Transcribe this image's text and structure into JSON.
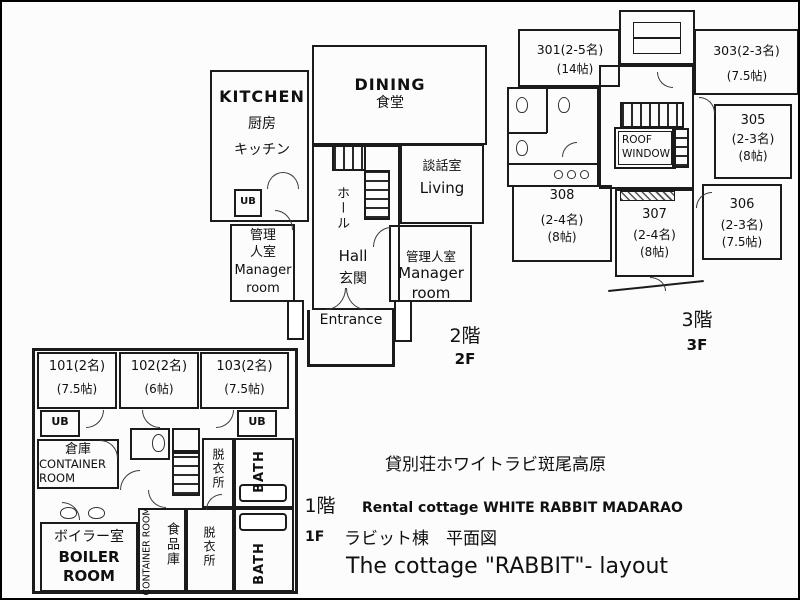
{
  "floor2": {
    "kitchen_en": "KITCHEN",
    "kitchen_jp1": "厨房",
    "kitchen_jp2": "キッチン",
    "dining_en": "DINING",
    "dining_jp": "食堂",
    "living_jp": "談話室",
    "living_en": "Living",
    "hall_jp": "ホール",
    "hall_en": "Hall",
    "genkan_jp": "玄関",
    "entrance_en": "Entrance",
    "ub": "UB",
    "mgr_left_jp1": "管理",
    "mgr_left_jp2": "人室",
    "mgr_left_en1": "Manager",
    "mgr_left_en2": "room",
    "mgr_right_jp": "管理人室",
    "mgr_right_en1": "Manager",
    "mgr_right_en2": "room",
    "floor_jp": "2階",
    "floor_en": "2F"
  },
  "floor3": {
    "r301_name": "301(2-5名)",
    "r301_size": "(14帖)",
    "r303_name": "303(2-3名)",
    "r303_size": "(7.5帖)",
    "r305_name": "305",
    "r305_cap": "(2-3名)",
    "r305_size": "(8帖)",
    "r306_name": "306",
    "r306_cap": "(2-3名)",
    "r306_size": "(7.5帖)",
    "r307_name": "307",
    "r307_cap": "(2-4名)",
    "r307_size": "(8帖)",
    "r308_name": "308",
    "r308_cap": "(2-4名)",
    "r308_size": "(8帖)",
    "roof1": "ROOF",
    "roof2": "WINDOW",
    "floor_jp": "3階",
    "floor_en": "3F"
  },
  "floor1": {
    "r101_name": "101(2名)",
    "r101_size": "(7.5帖)",
    "r102_name": "102(2名)",
    "r102_size": "(6帖)",
    "r103_name": "103(2名)",
    "r103_size": "(7.5帖)",
    "ub": "UB",
    "container_jp": "倉庫",
    "container_en1": "CONTAINER",
    "container_en2": "ROOM",
    "container_mid_en": "CONTAINER ROOM",
    "pantry_jp": "食品庫",
    "datsui_jp": "脱衣所",
    "bath_en": "BATH",
    "boiler_jp": "ボイラー室",
    "boiler_en1": "BOILER",
    "boiler_en2": "ROOM"
  },
  "caption": {
    "title_jp": "貸別荘ホワイトラビ斑尾高原",
    "floor1_jp": "1階",
    "rental_en": "Rental cottage WHITE RABBIT MADARAO",
    "floor1_en": "1F",
    "plan_jp": "ラビット棟　平面図",
    "title_en": "The cottage \"RABBIT\"- layout"
  }
}
